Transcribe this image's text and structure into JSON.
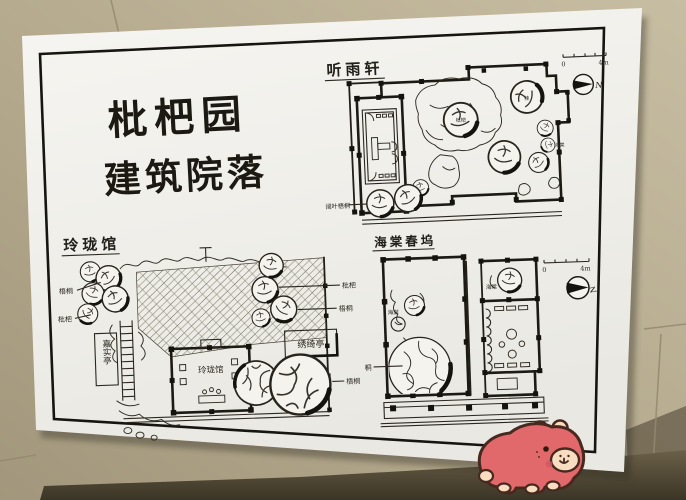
{
  "photo": {
    "alt": "hand-drawn garden architecture plan sheet lying on beige tiled floor"
  },
  "title": {
    "line1": "枇杷园",
    "line2": "建筑院落"
  },
  "tingyuxuan": {
    "title": "听雨轩",
    "scale0": "0",
    "scale1": "4m",
    "north": "N",
    "sw_trees": "阔叶梧桐",
    "tree_pipa": "枇杷",
    "tree_gui": "桂",
    "tree_haitang": "海棠"
  },
  "linglong": {
    "title": "玲珑馆",
    "hall": "玲珑馆",
    "jiashiting": "嘉实亭",
    "xiuqiting": "绣绮亭",
    "wutong_left": "梧桐",
    "pipa_left": "枇杷",
    "pipa_right": "枇杷",
    "wutong_right": "梧桐",
    "wutong_bottom": "梧桐"
  },
  "haitang": {
    "title": "海棠春坞",
    "scale0": "0",
    "scale1": "4m",
    "north": "N",
    "haitang_court": "海棠",
    "haitang_room": "海棠",
    "tong": "桐"
  },
  "sticker": {
    "name": "pink-capybara-sticker"
  },
  "colors": {
    "floor": "#b6ab90",
    "floor_shadow": "#4e4736",
    "paper": "#f4f3ee",
    "ink": "#26231c",
    "sticker_body": "#e2696b",
    "sticker_cream": "#f9ddc1",
    "sticker_outline": "#47291f"
  }
}
